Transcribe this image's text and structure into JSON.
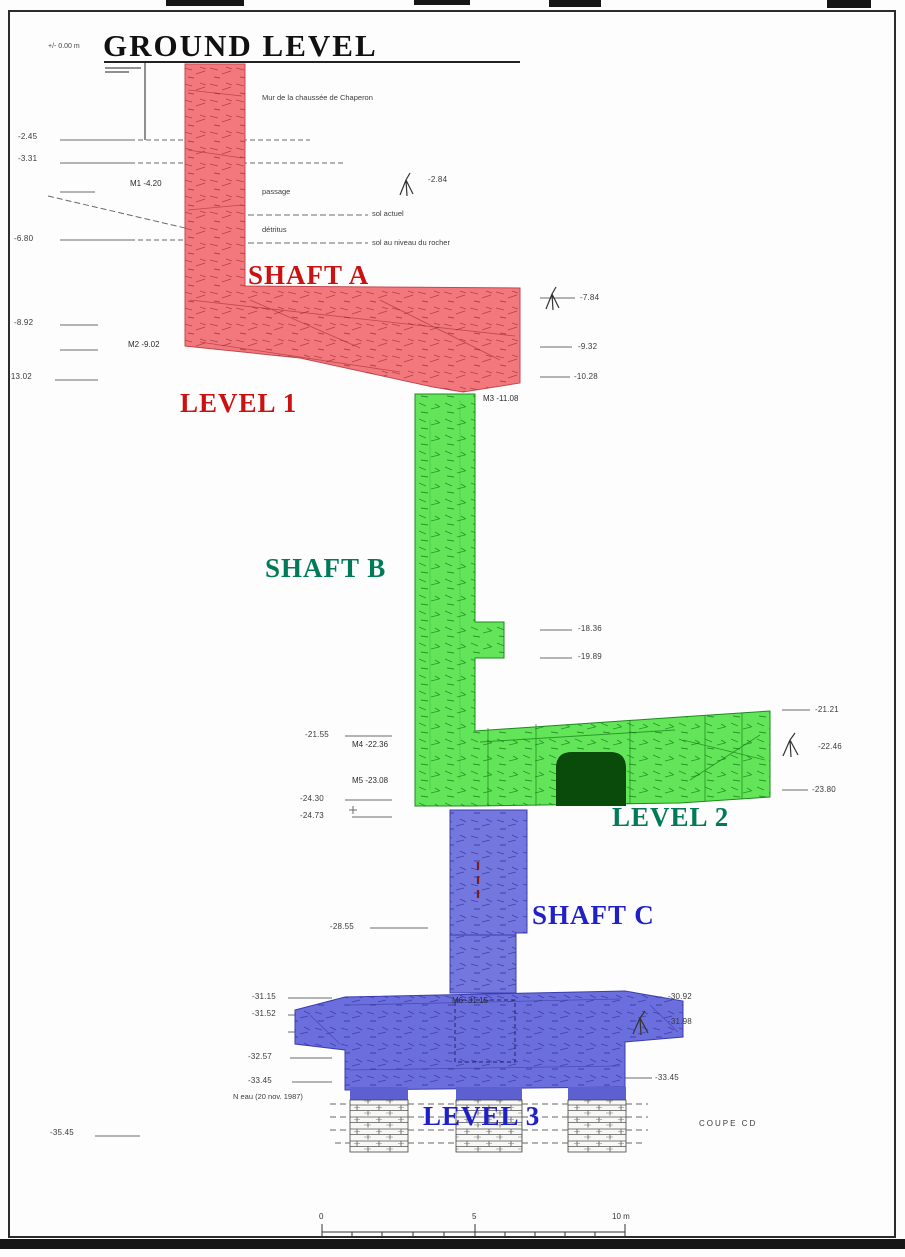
{
  "title": {
    "text": "GROUND LEVEL",
    "datum": "+/- 0.00 m"
  },
  "section_ref": "COUPE CD",
  "colors": {
    "shaft_a_fill": "#f2787d",
    "shaft_b_fill": "#63e55a",
    "shaft_c_fill": "#7477de",
    "red_label": "#cc1111",
    "green_label": "#007a58",
    "blue_label": "#2020c8",
    "door_fill": "#0a4a0a"
  },
  "floating_labels": [
    {
      "text": "SHAFT A",
      "x": 248,
      "y": 262,
      "cls": "big",
      "color": "#cc1111",
      "name": "shaft-a-label"
    },
    {
      "text": "LEVEL 1",
      "x": 180,
      "y": 390,
      "cls": "big",
      "color": "#cc1111",
      "name": "level-1-label"
    },
    {
      "text": "SHAFT B",
      "x": 265,
      "y": 555,
      "cls": "big",
      "color": "#007a58",
      "name": "shaft-b-label"
    },
    {
      "text": "LEVEL 2",
      "x": 612,
      "y": 804,
      "cls": "big",
      "color": "#007a58",
      "name": "level-2-label"
    },
    {
      "text": "SHAFT C",
      "x": 532,
      "y": 902,
      "cls": "big",
      "color": "#2020c8",
      "name": "shaft-c-label"
    },
    {
      "text": "LEVEL 3",
      "x": 423,
      "y": 1103,
      "cls": "big",
      "color": "#2020c8",
      "name": "level-3-label"
    },
    {
      "text": "-2.45",
      "x": 18,
      "y": 133,
      "cls": "depth",
      "name": "depth-2-45"
    },
    {
      "text": "-3.31",
      "x": 18,
      "y": 155,
      "cls": "depth",
      "name": "depth-3-31"
    },
    {
      "text": "-6.80",
      "x": 14,
      "y": 235,
      "cls": "depth",
      "name": "depth-6-80"
    },
    {
      "text": "-8.92",
      "x": 14,
      "y": 319,
      "cls": "depth",
      "name": "depth-8-92"
    },
    {
      "text": "-13.02",
      "x": 8,
      "y": 373,
      "cls": "depth",
      "name": "depth-13-02"
    },
    {
      "text": "-2.84",
      "x": 428,
      "y": 176,
      "cls": "depth",
      "name": "depth-2-84"
    },
    {
      "text": "-7.84",
      "x": 580,
      "y": 294,
      "cls": "depth",
      "name": "depth-7-84"
    },
    {
      "text": "-9.32",
      "x": 578,
      "y": 343,
      "cls": "depth",
      "name": "depth-9-32"
    },
    {
      "text": "-10.28",
      "x": 574,
      "y": 373,
      "cls": "depth",
      "name": "depth-10-28"
    },
    {
      "text": "-18.36",
      "x": 578,
      "y": 625,
      "cls": "depth",
      "name": "depth-18-36"
    },
    {
      "text": "-19.89",
      "x": 578,
      "y": 653,
      "cls": "depth",
      "name": "depth-19-89"
    },
    {
      "text": "-21.55",
      "x": 305,
      "y": 731,
      "cls": "depth",
      "name": "depth-21-55"
    },
    {
      "text": "-24.30",
      "x": 300,
      "y": 795,
      "cls": "depth",
      "name": "depth-24-30"
    },
    {
      "text": "-24.73",
      "x": 300,
      "y": 812,
      "cls": "depth",
      "name": "depth-24-73"
    },
    {
      "text": "-21.21",
      "x": 815,
      "y": 706,
      "cls": "depth",
      "name": "depth-21-21"
    },
    {
      "text": "-22.46",
      "x": 818,
      "y": 743,
      "cls": "depth",
      "name": "depth-22-46"
    },
    {
      "text": "-23.80",
      "x": 812,
      "y": 786,
      "cls": "depth",
      "name": "depth-23-80"
    },
    {
      "text": "-28.55",
      "x": 330,
      "y": 923,
      "cls": "depth",
      "name": "depth-28-55"
    },
    {
      "text": "-31.15",
      "x": 252,
      "y": 993,
      "cls": "depth",
      "name": "depth-31-15"
    },
    {
      "text": "-31.52",
      "x": 252,
      "y": 1010,
      "cls": "depth",
      "name": "depth-31-52"
    },
    {
      "text": "-32.57",
      "x": 248,
      "y": 1053,
      "cls": "depth",
      "name": "depth-32-57"
    },
    {
      "text": "-33.45",
      "x": 248,
      "y": 1077,
      "cls": "depth",
      "name": "depth-33-45-left"
    },
    {
      "text": "-30.92",
      "x": 668,
      "y": 993,
      "cls": "depth",
      "name": "depth-30-92"
    },
    {
      "text": "-31.98",
      "x": 668,
      "y": 1018,
      "cls": "depth",
      "name": "depth-31-98"
    },
    {
      "text": "-33.45",
      "x": 655,
      "y": 1074,
      "cls": "depth",
      "name": "depth-33-45-right"
    },
    {
      "text": "-35.45",
      "x": 50,
      "y": 1129,
      "cls": "depth",
      "name": "depth-35-45"
    },
    {
      "text": "M1 -4.20",
      "x": 130,
      "y": 180,
      "cls": "station",
      "name": "station-m1"
    },
    {
      "text": "M2 -9.02",
      "x": 128,
      "y": 341,
      "cls": "station",
      "name": "station-m2"
    },
    {
      "text": "M3 -11.08",
      "x": 483,
      "y": 395,
      "cls": "station",
      "name": "station-m3"
    },
    {
      "text": "M4 -22.36",
      "x": 352,
      "y": 741,
      "cls": "station",
      "name": "station-m4"
    },
    {
      "text": "M5 -23.08",
      "x": 352,
      "y": 777,
      "cls": "station",
      "name": "station-m5"
    },
    {
      "text": "M6 -31.15",
      "x": 452,
      "y": 997,
      "cls": "station",
      "name": "station-m6"
    },
    {
      "text": "Mur de la chaussée de Chaperon",
      "x": 262,
      "y": 94,
      "cls": "note",
      "name": "note-wall"
    },
    {
      "text": "passage",
      "x": 262,
      "y": 188,
      "cls": "note",
      "name": "note-passage"
    },
    {
      "text": "sol actuel",
      "x": 372,
      "y": 210,
      "cls": "note",
      "name": "note-sol-actuel"
    },
    {
      "text": "détritus",
      "x": 262,
      "y": 226,
      "cls": "note",
      "name": "note-detritus"
    },
    {
      "text": "sol au niveau du rocher",
      "x": 372,
      "y": 239,
      "cls": "note",
      "name": "note-sol-rocher"
    },
    {
      "text": "N eau (20 nov. 1987)",
      "x": 233,
      "y": 1093,
      "cls": "note",
      "name": "note-water-level"
    },
    {
      "text": "0",
      "x": 319,
      "y": 1213,
      "cls": "scale",
      "name": "scale-tick-0"
    },
    {
      "text": "5",
      "x": 472,
      "y": 1213,
      "cls": "scale",
      "name": "scale-tick-5"
    },
    {
      "text": "10 m",
      "x": 612,
      "y": 1213,
      "cls": "scale",
      "name": "scale-tick-10"
    }
  ]
}
